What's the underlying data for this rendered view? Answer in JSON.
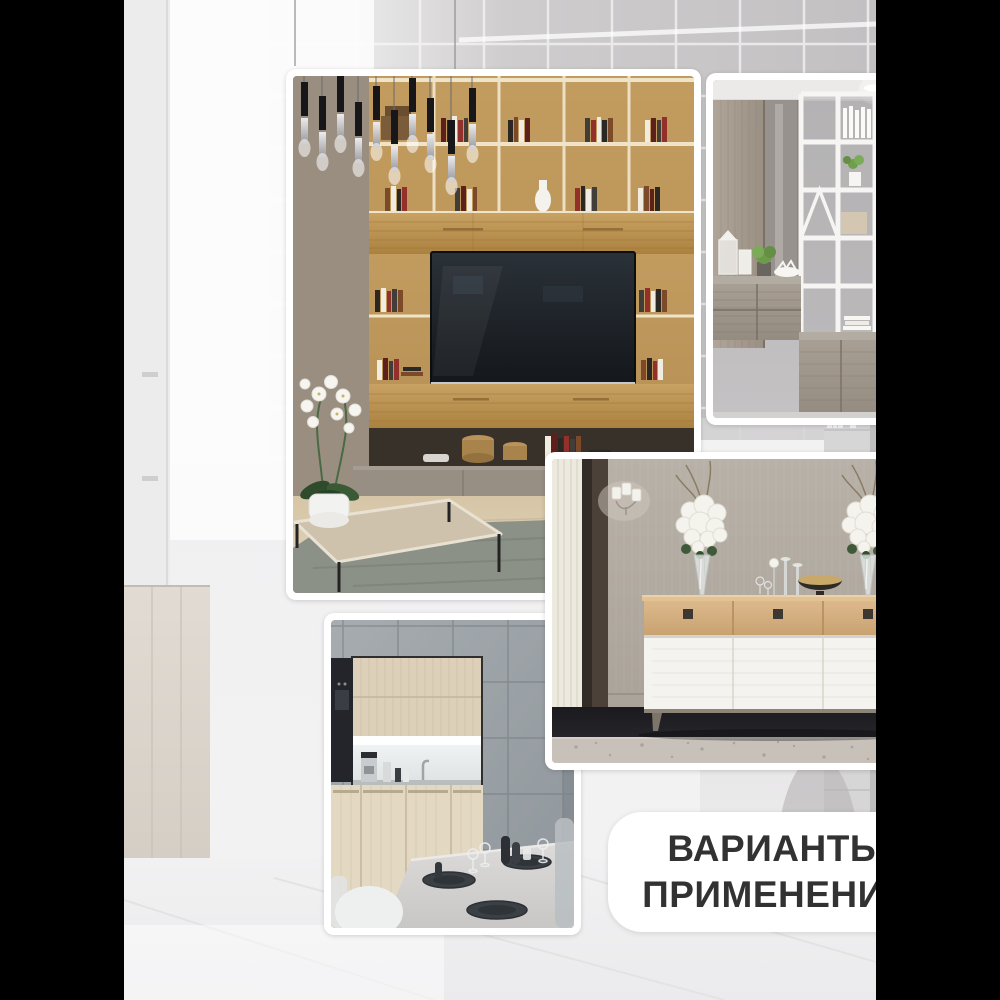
{
  "canvas": {
    "width": 1000,
    "height": 1000,
    "letterbox_color": "#000000"
  },
  "backdrop": {
    "name": "blurred-light-interior-with-glass-tiles-and-bookshelves",
    "base_color": "#f2f2f3",
    "tile_color": "#cecccd",
    "shelf_color": "#d7d6d7"
  },
  "badge": {
    "line1": "ВАРИАНТЫ",
    "line2": "ПРИМЕНЕНИЯ",
    "background": "#ffffff",
    "text_color": "#323232"
  },
  "photos": [
    {
      "name": "living-room-oak-tv-wall-unit",
      "dominant_colors": [
        "#b99257",
        "#1d2227",
        "#a1958a",
        "#8c9187"
      ]
    },
    {
      "name": "white-lattice-shelving-room-divider",
      "dominant_colors": [
        "#f5f4f2",
        "#9d948a",
        "#b9b7b8"
      ]
    },
    {
      "name": "oak-and-white-sideboard-with-rose-vases",
      "dominant_colors": [
        "#d2ab77",
        "#f5f3ef",
        "#b3aba1",
        "#17161a"
      ]
    },
    {
      "name": "grey-tile-kitchen-with-dining-table",
      "dominant_colors": [
        "#9aa1a6",
        "#ddd0b8",
        "#d9d7d5",
        "#3b4045"
      ]
    }
  ]
}
